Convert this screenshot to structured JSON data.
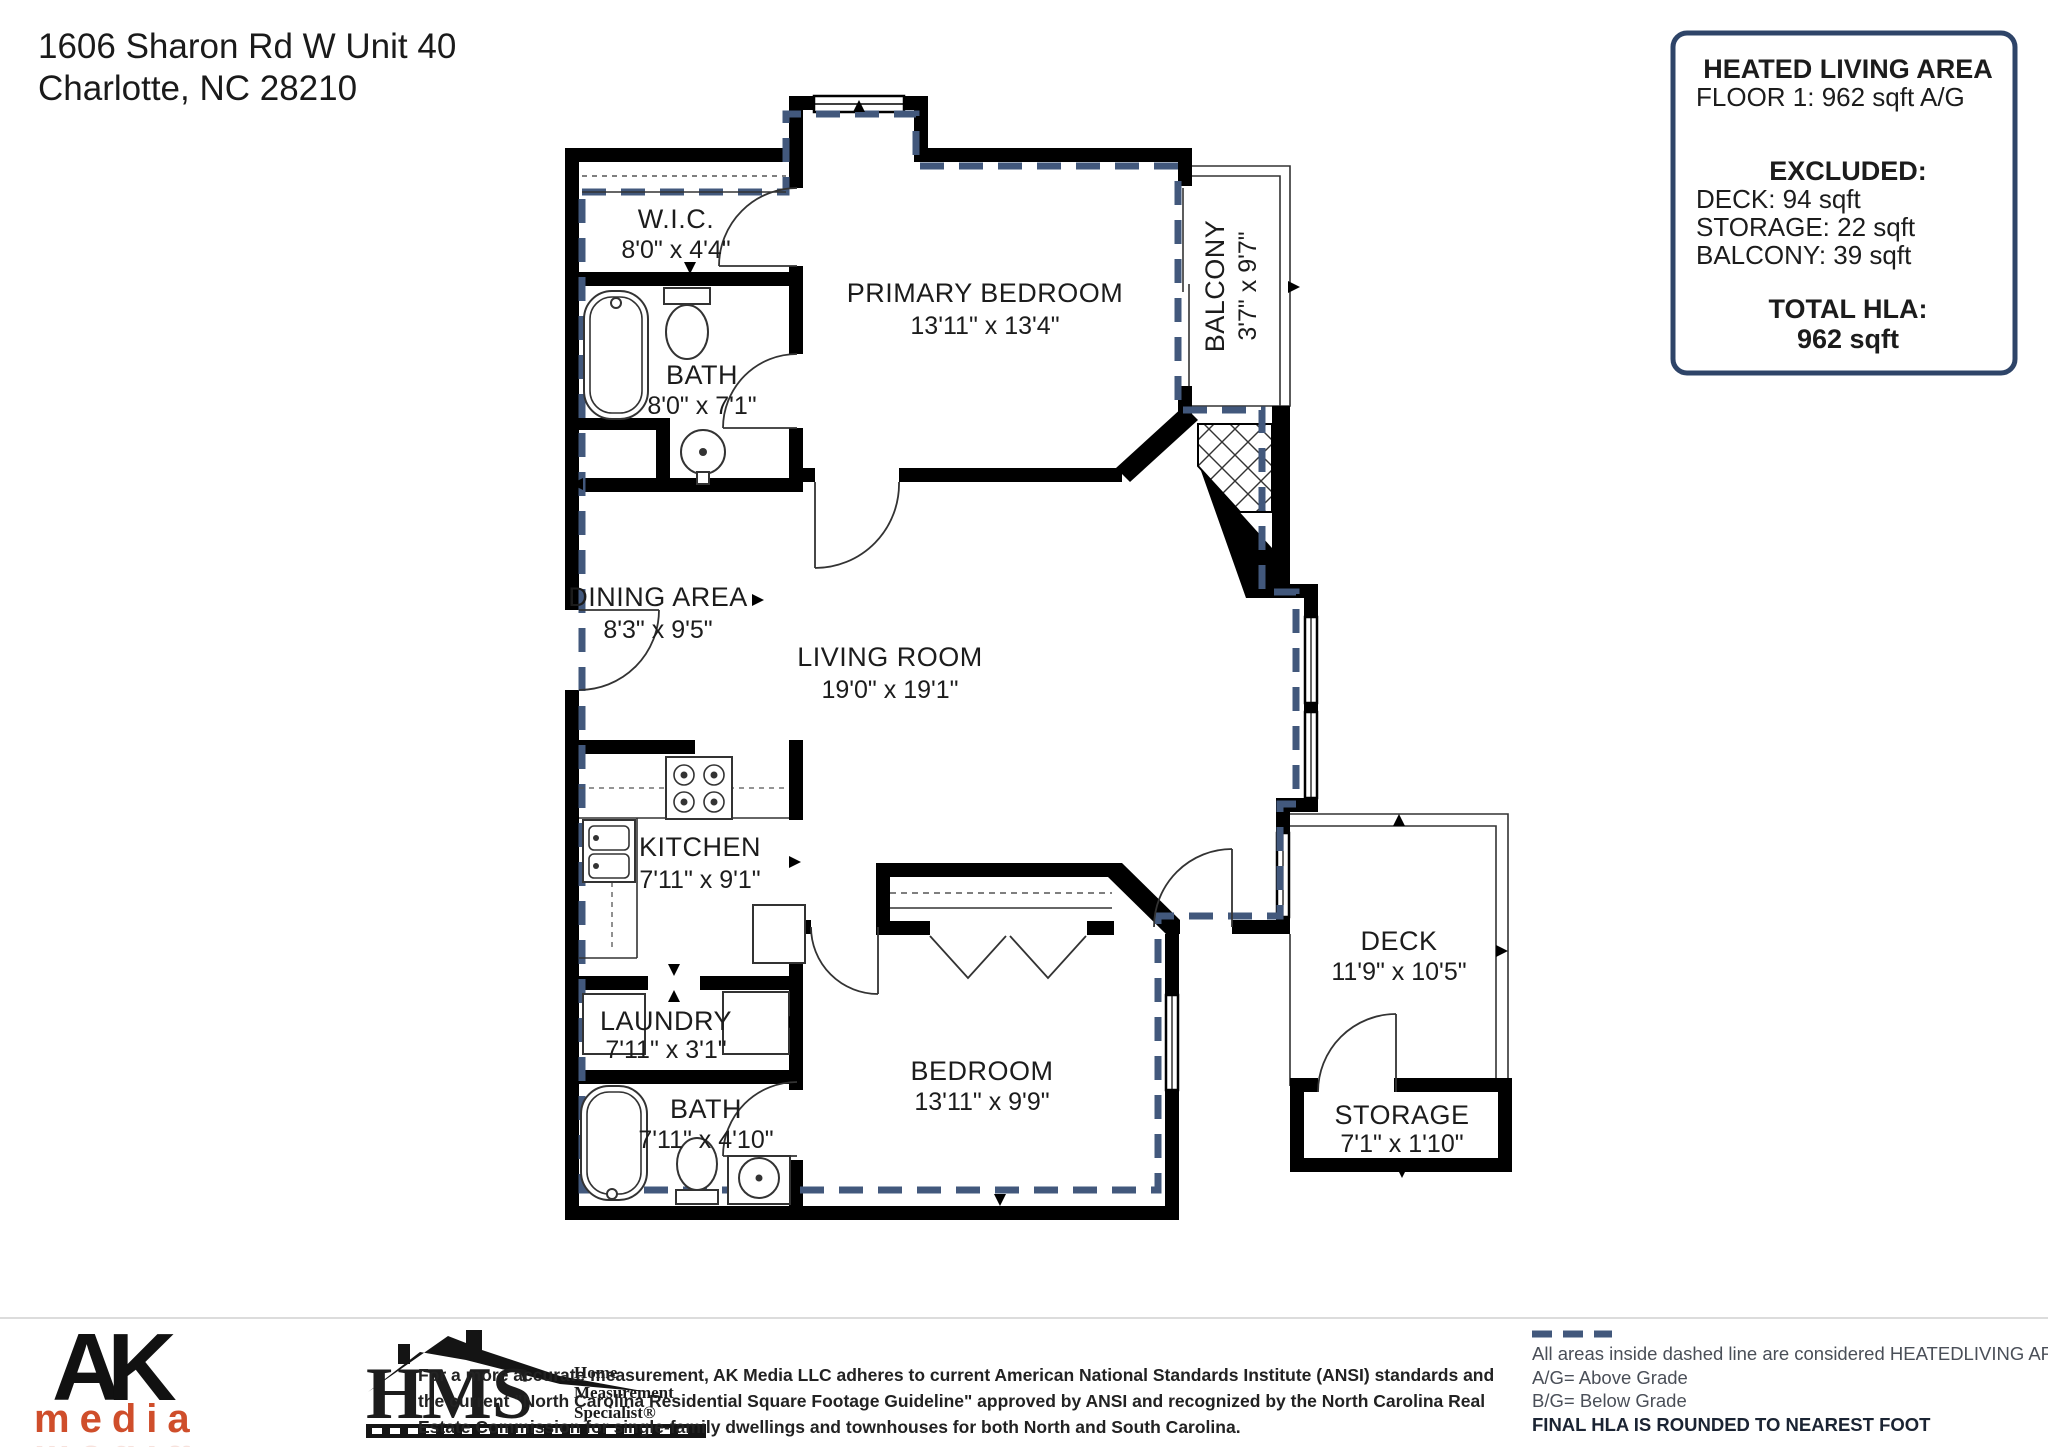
{
  "address": {
    "line1": "1606 Sharon Rd W Unit 40",
    "line2": "Charlotte, NC  28210"
  },
  "hla_box": {
    "title": "HEATED LIVING AREA",
    "floor_line": "FLOOR 1: 962 sqft  A/G",
    "excluded_title": "EXCLUDED:",
    "excluded_deck": "DECK: 94 sqft",
    "excluded_storage": "STORAGE: 22 sqft",
    "excluded_balcony": "BALCONY: 39 sqft",
    "total_label": "TOTAL HLA:",
    "total_value": "962 sqft",
    "border_color": "#2e4468"
  },
  "plan": {
    "rooms": {
      "wic": {
        "name": "W.I.C.",
        "dims": "8'0\" x 4'4\""
      },
      "bath1": {
        "name": "BATH",
        "dims": "8'0\" x 7'1\""
      },
      "primary": {
        "name": "PRIMARY BEDROOM",
        "dims": "13'11\" x 13'4\""
      },
      "balcony": {
        "name": "BALCONY",
        "dims": "3'7\" x 9'7\""
      },
      "dining": {
        "name": "DINING AREA",
        "dims": "8'3\" x 9'5\""
      },
      "living": {
        "name": "LIVING ROOM",
        "dims": "19'0\" x 19'1\""
      },
      "kitchen": {
        "name": "KITCHEN",
        "dims": "7'11\" x 9'1\""
      },
      "laundry": {
        "name": "LAUNDRY",
        "dims": "7'11\" x 3'1\""
      },
      "bath2": {
        "name": "BATH",
        "dims": "7'11\" x 4'10\""
      },
      "bedroom": {
        "name": "BEDROOM",
        "dims": "13'11\" x 9'9\""
      },
      "deck": {
        "name": "DECK",
        "dims": "11'9\" x 10'5\""
      },
      "storage": {
        "name": "STORAGE",
        "dims": "7'1\" x 1'10\""
      }
    },
    "heated_boundary_color": "#42587c"
  },
  "legend": {
    "line1": "All areas inside dashed line are considered HEATEDLIVING AREA.",
    "line2": "A/G= Above Grade",
    "line3": "B/G= Below Grade",
    "line4": "FINAL HLA IS ROUNDED TO NEAREST FOOT"
  },
  "footer": {
    "disclaimer_line1": "For a more accurate measurement, AK Media LLC adheres to current American National Standards Institute (ANSI) standards and",
    "disclaimer_line2": "the current \"North Carolina Residential Square Footage Guideline\" approved by ANSI and recognized by the North Carolina Real",
    "disclaimer_line3": "Estate Commission for single-family dwellings and townhouses for both North and South Carolina.",
    "ak_logo": {
      "letters": "AK",
      "word": "media",
      "orange": "#cf4e2b"
    },
    "hms_logo": {
      "h": "H",
      "ms": "MS",
      "line1": "Home",
      "line2": "Measurement",
      "line3": "Specialist®",
      "gold": "#8f6b2e"
    }
  }
}
